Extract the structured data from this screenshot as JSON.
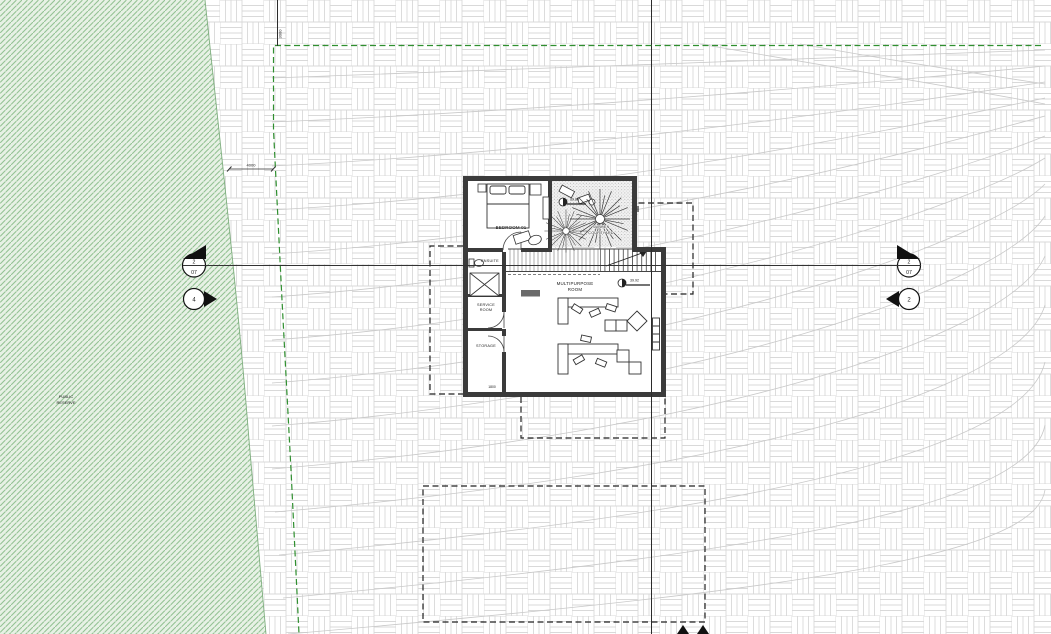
{
  "site": {
    "reserve_label_line1": "PUBLIC",
    "reserve_label_line2": "RESERVE"
  },
  "rooms": {
    "bedroom": "BEDROOM 01",
    "ensuite": "ENSUITE",
    "service_room_line1": "SERVICE",
    "service_room_line2": "ROOM",
    "storage": "STORAGE",
    "multipurpose_line1": "MULTIPURPOSE",
    "multipurpose_line2": "ROOM",
    "courtyard_line1": "SUNKEN",
    "courtyard_line2": "COURTYARD"
  },
  "levels": {
    "courtyard_rl": "39.88",
    "multipurpose_rl": "39.92"
  },
  "dimensions": {
    "north_setback": "3000",
    "west_setback": "4000",
    "storage_width": "1800"
  },
  "markers": {
    "section_left": {
      "number": "2",
      "sheet": "07"
    },
    "section_right": {
      "number": "2",
      "sheet": "07"
    },
    "elevation_left": {
      "number": "4"
    },
    "elevation_right": {
      "number": "2"
    }
  },
  "colors": {
    "reserve_green_fill": "#e7f1e5",
    "reserve_green_hatch": "#94c294",
    "boundary_dash_green": "#2f8f2f",
    "wall_dark": "#3b3b3b",
    "contour_gray": "#c9c9c9",
    "weave_gray": "#d9d9d9"
  }
}
